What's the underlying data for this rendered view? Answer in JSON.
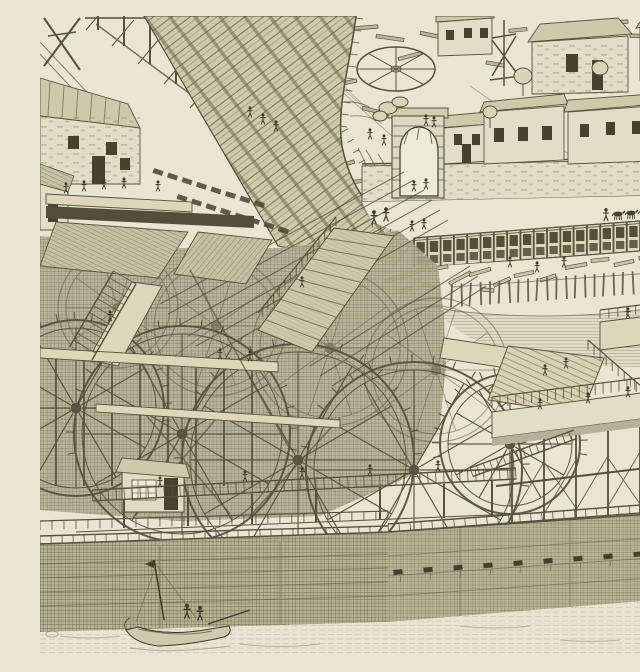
{
  "meta": {
    "type": "antique-engraving",
    "alt": "Bird's-eye engraving of the Machine de Marly: a great pipe ramp descends from the upper left past a stone house toward a riverside pumping works of large paddle water wheels on timber platforms; above, a walled courtyard with an arched gate, stone houses, a flat wheel and scattered timbers; to the right a long trestle gallery, log-strewn bank and palisade edge an upper pool; below, a dark timber dam wall with water spouts holds the river, where a small boat with two figures floats."
  },
  "palette": {
    "paper": "#e9e5d3",
    "paper_dark": "#ddd8bd",
    "ink": "#55523c",
    "ink_dark": "#3c3a2a",
    "mid_tone": "#b2ad90",
    "opening_dark": "#45432f",
    "water_line": "#6e6a50"
  },
  "scene": {
    "wheels_front": [
      [
        36,
        392,
        88
      ],
      [
        142,
        418,
        108
      ],
      [
        258,
        444,
        116
      ],
      [
        374,
        454,
        108
      ],
      [
        470,
        428,
        70
      ]
    ],
    "wheels_back": [
      [
        78,
        292,
        60
      ],
      [
        176,
        310,
        70
      ],
      [
        290,
        332,
        78
      ],
      [
        396,
        354,
        72
      ]
    ],
    "figures": [
      [
        210,
        98
      ],
      [
        223,
        105
      ],
      [
        236,
        112
      ],
      [
        330,
        120
      ],
      [
        344,
        126
      ],
      [
        386,
        106
      ],
      [
        394,
        108
      ],
      [
        374,
        172
      ],
      [
        386,
        170
      ],
      [
        334,
        204,
        1.1
      ],
      [
        346,
        201,
        1.1
      ],
      [
        372,
        212
      ],
      [
        384,
        210
      ],
      [
        470,
        248
      ],
      [
        497,
        253
      ],
      [
        524,
        248
      ],
      [
        26,
        174
      ],
      [
        44,
        172
      ],
      [
        64,
        170
      ],
      [
        84,
        169
      ],
      [
        118,
        172
      ],
      [
        262,
        268
      ],
      [
        180,
        340
      ],
      [
        210,
        342
      ],
      [
        70,
        302
      ],
      [
        120,
        468
      ],
      [
        205,
        462
      ],
      [
        262,
        459
      ],
      [
        330,
        456
      ],
      [
        398,
        452
      ],
      [
        505,
        356
      ],
      [
        526,
        349
      ],
      [
        500,
        390
      ],
      [
        548,
        384
      ],
      [
        588,
        378
      ],
      [
        614,
        374
      ],
      [
        588,
        299
      ],
      [
        604,
        295
      ],
      [
        147,
        598,
        1.15
      ],
      [
        160,
        600,
        1.15
      ]
    ],
    "horses": [
      [
        578,
        198
      ],
      [
        591,
        197
      ],
      [
        604,
        196
      ],
      [
        617,
        195
      ],
      [
        630,
        194
      ]
    ],
    "driver": [
      566,
      201
    ],
    "timbers": [
      [
        255,
        18,
        30,
        -15
      ],
      [
        285,
        30,
        24,
        10
      ],
      [
        320,
        12,
        36,
        -5
      ],
      [
        350,
        22,
        28,
        8
      ],
      [
        262,
        52,
        22,
        -30
      ],
      [
        300,
        68,
        34,
        -12
      ],
      [
        335,
        95,
        26,
        14
      ],
      [
        270,
        95,
        20,
        5
      ],
      [
        395,
        20,
        30,
        12
      ],
      [
        415,
        35,
        26,
        -8
      ],
      [
        440,
        25,
        22,
        6
      ],
      [
        370,
        40,
        24,
        -15
      ],
      [
        455,
        48,
        18,
        10
      ],
      [
        300,
        150,
        30,
        -18
      ],
      [
        320,
        165,
        24,
        -8
      ],
      [
        350,
        180,
        28,
        -20
      ],
      [
        255,
        120,
        18,
        -40
      ],
      [
        282,
        140,
        16,
        22
      ],
      [
        540,
        8,
        28,
        3
      ],
      [
        575,
        6,
        26,
        -2
      ],
      [
        610,
        10,
        24,
        4
      ],
      [
        600,
        20,
        20,
        2
      ],
      [
        478,
        14,
        18,
        -6
      ]
    ],
    "logs": [
      [
        356,
        262,
        22,
        -18
      ],
      [
        376,
        256,
        26,
        -22
      ],
      [
        398,
        252,
        20,
        -10
      ],
      [
        420,
        262,
        24,
        -28
      ],
      [
        365,
        274,
        18,
        -12
      ],
      [
        440,
        256,
        22,
        -16
      ],
      [
        462,
        266,
        18,
        -24
      ],
      [
        484,
        258,
        20,
        -12
      ],
      [
        508,
        262,
        16,
        -18
      ],
      [
        536,
        250,
        22,
        -10
      ],
      [
        560,
        244,
        18,
        -6
      ],
      [
        584,
        247,
        20,
        -12
      ],
      [
        608,
        241,
        18,
        -8
      ],
      [
        628,
        245,
        16,
        -14
      ],
      [
        390,
        270,
        14,
        8
      ],
      [
        448,
        274,
        12,
        6
      ]
    ],
    "pipe_rows": [
      {
        "x": 118,
        "y": 156,
        "n": 8,
        "sx": 14.5,
        "sy": 4.6,
        "ang": 18
      },
      {
        "x": 142,
        "y": 182,
        "n": 8,
        "sx": 14.5,
        "sy": 4.6,
        "ang": 18
      }
    ],
    "ramp_fringe": [
      {
        "x1": 316,
        "y1": 2,
        "x2": 300,
        "y2": 110,
        "n": 9,
        "len": 7
      },
      {
        "x1": 302,
        "y1": 116,
        "x2": 352,
        "y2": 210,
        "n": 9,
        "len": 7
      }
    ],
    "gallery": {
      "x1": 374,
      "y1": 222,
      "x2": 640,
      "y2": 202,
      "h": 30,
      "step": 13.3
    },
    "palisade": {
      "x1": 412,
      "y1": 268,
      "x2": 640,
      "y2": 252,
      "step": 9.5,
      "h": 23,
      "tilts": [
        -4,
        2,
        -6,
        3,
        0,
        -3,
        5,
        -2,
        1,
        -5,
        3,
        -1,
        4,
        -3,
        2,
        0,
        -4,
        3,
        -2,
        5,
        -1,
        2,
        -3,
        1
      ]
    },
    "spouts": {
      "xs": [
        358,
        388,
        418,
        448,
        478,
        508,
        538,
        568,
        598,
        626
      ],
      "y1": 556,
      "y2": 536
    },
    "ladders": [
      {
        "x1": 52,
        "y1": 474,
        "x2": 476,
        "y2": 452,
        "w": 11,
        "step": 8
      },
      {
        "x1": 430,
        "y1": 452,
        "x2": 534,
        "y2": 414,
        "w": 9,
        "step": 7
      },
      {
        "x1": 96,
        "y1": 268,
        "x2": 52,
        "y2": 344,
        "w": 26,
        "step": 8
      },
      {
        "x1": 0,
        "y1": 520,
        "x2": 348,
        "y2": 510,
        "w": 8,
        "step": 11
      },
      {
        "x1": 348,
        "y1": 508,
        "x2": 640,
        "y2": 486,
        "w": 8,
        "step": 11
      }
    ],
    "balusters": [
      {
        "x1": 452,
        "y1": 392,
        "x2": 640,
        "y2": 368,
        "h": 11,
        "step": 8
      },
      {
        "x1": 548,
        "y1": 334,
        "x2": 640,
        "y2": 414,
        "h": 10,
        "step": 8
      },
      {
        "x1": 0,
        "y1": 514,
        "x2": 348,
        "y2": 504,
        "h": 9,
        "step": 12
      },
      {
        "x1": 296,
        "y1": 210,
        "x2": 218,
        "y2": 306,
        "h": 9,
        "step": 9
      },
      {
        "x1": 560,
        "y1": 303,
        "x2": 640,
        "y2": 293,
        "h": 9,
        "step": 9
      }
    ],
    "drive_rods": [
      [
        392,
        184,
        148,
        320
      ],
      [
        400,
        194,
        156,
        330
      ],
      [
        408,
        204,
        166,
        342
      ],
      [
        384,
        174,
        138,
        310
      ],
      [
        374,
        164,
        128,
        298
      ],
      [
        364,
        156,
        120,
        288
      ],
      [
        430,
        250,
        270,
        350
      ],
      [
        438,
        260,
        280,
        360
      ],
      [
        446,
        270,
        292,
        370
      ]
    ],
    "trestle_posts_topleft": [
      [
        58,
        14
      ],
      [
        84,
        30
      ],
      [
        110,
        48
      ],
      [
        136,
        68
      ],
      [
        162,
        92
      ],
      [
        188,
        116
      ]
    ]
  }
}
